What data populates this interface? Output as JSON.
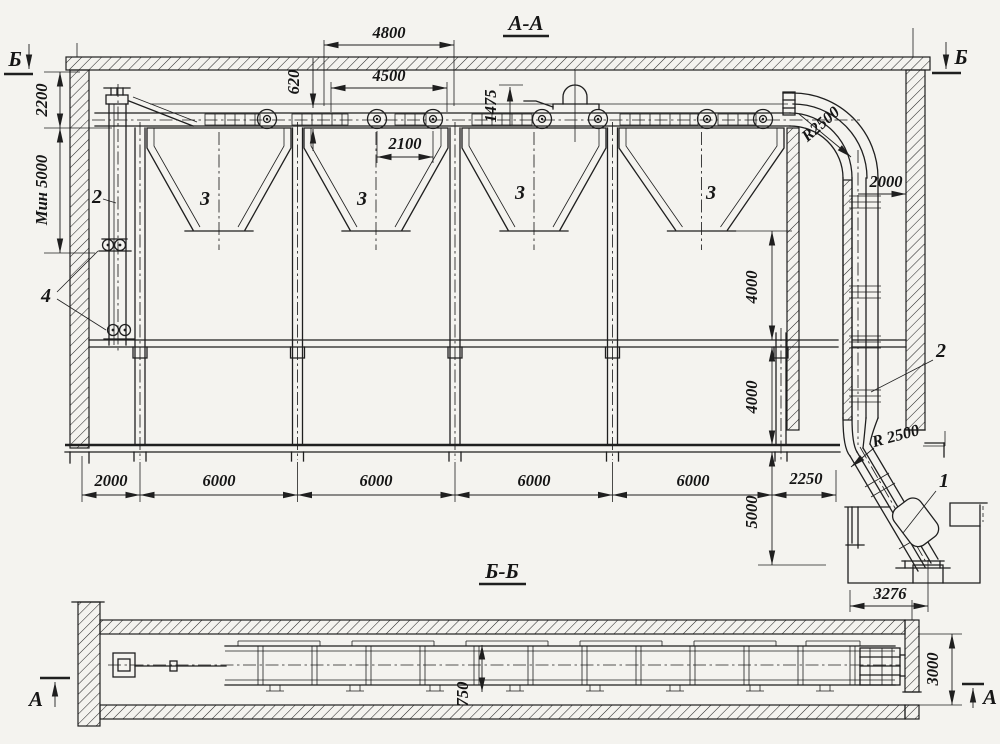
{
  "section_aa": {
    "title": "А-А",
    "marker_left": "Б",
    "marker_right": "Б",
    "dims": {
      "d4800": "4800",
      "d4500": "4500",
      "d620": "620",
      "d2100": "2100",
      "d1475": "1475",
      "d2200": "2200",
      "dmin5000": "Мин 5000",
      "d2000r": "2000",
      "r2500t": "R2500",
      "r2500b": "R 2500",
      "d4000a": "4000",
      "d4000b": "4000",
      "d5000": "5000",
      "d3276": "3276",
      "row": [
        "2000",
        "6000",
        "6000",
        "6000",
        "6000",
        "2250"
      ]
    },
    "parts": {
      "p1": "1",
      "p2": "2",
      "p3": "3",
      "p4": "4"
    }
  },
  "section_bb": {
    "title": "Б-Б",
    "marker_left": "А",
    "marker_right": "А",
    "dims": {
      "d3000": "3000",
      "d750": "750"
    }
  }
}
